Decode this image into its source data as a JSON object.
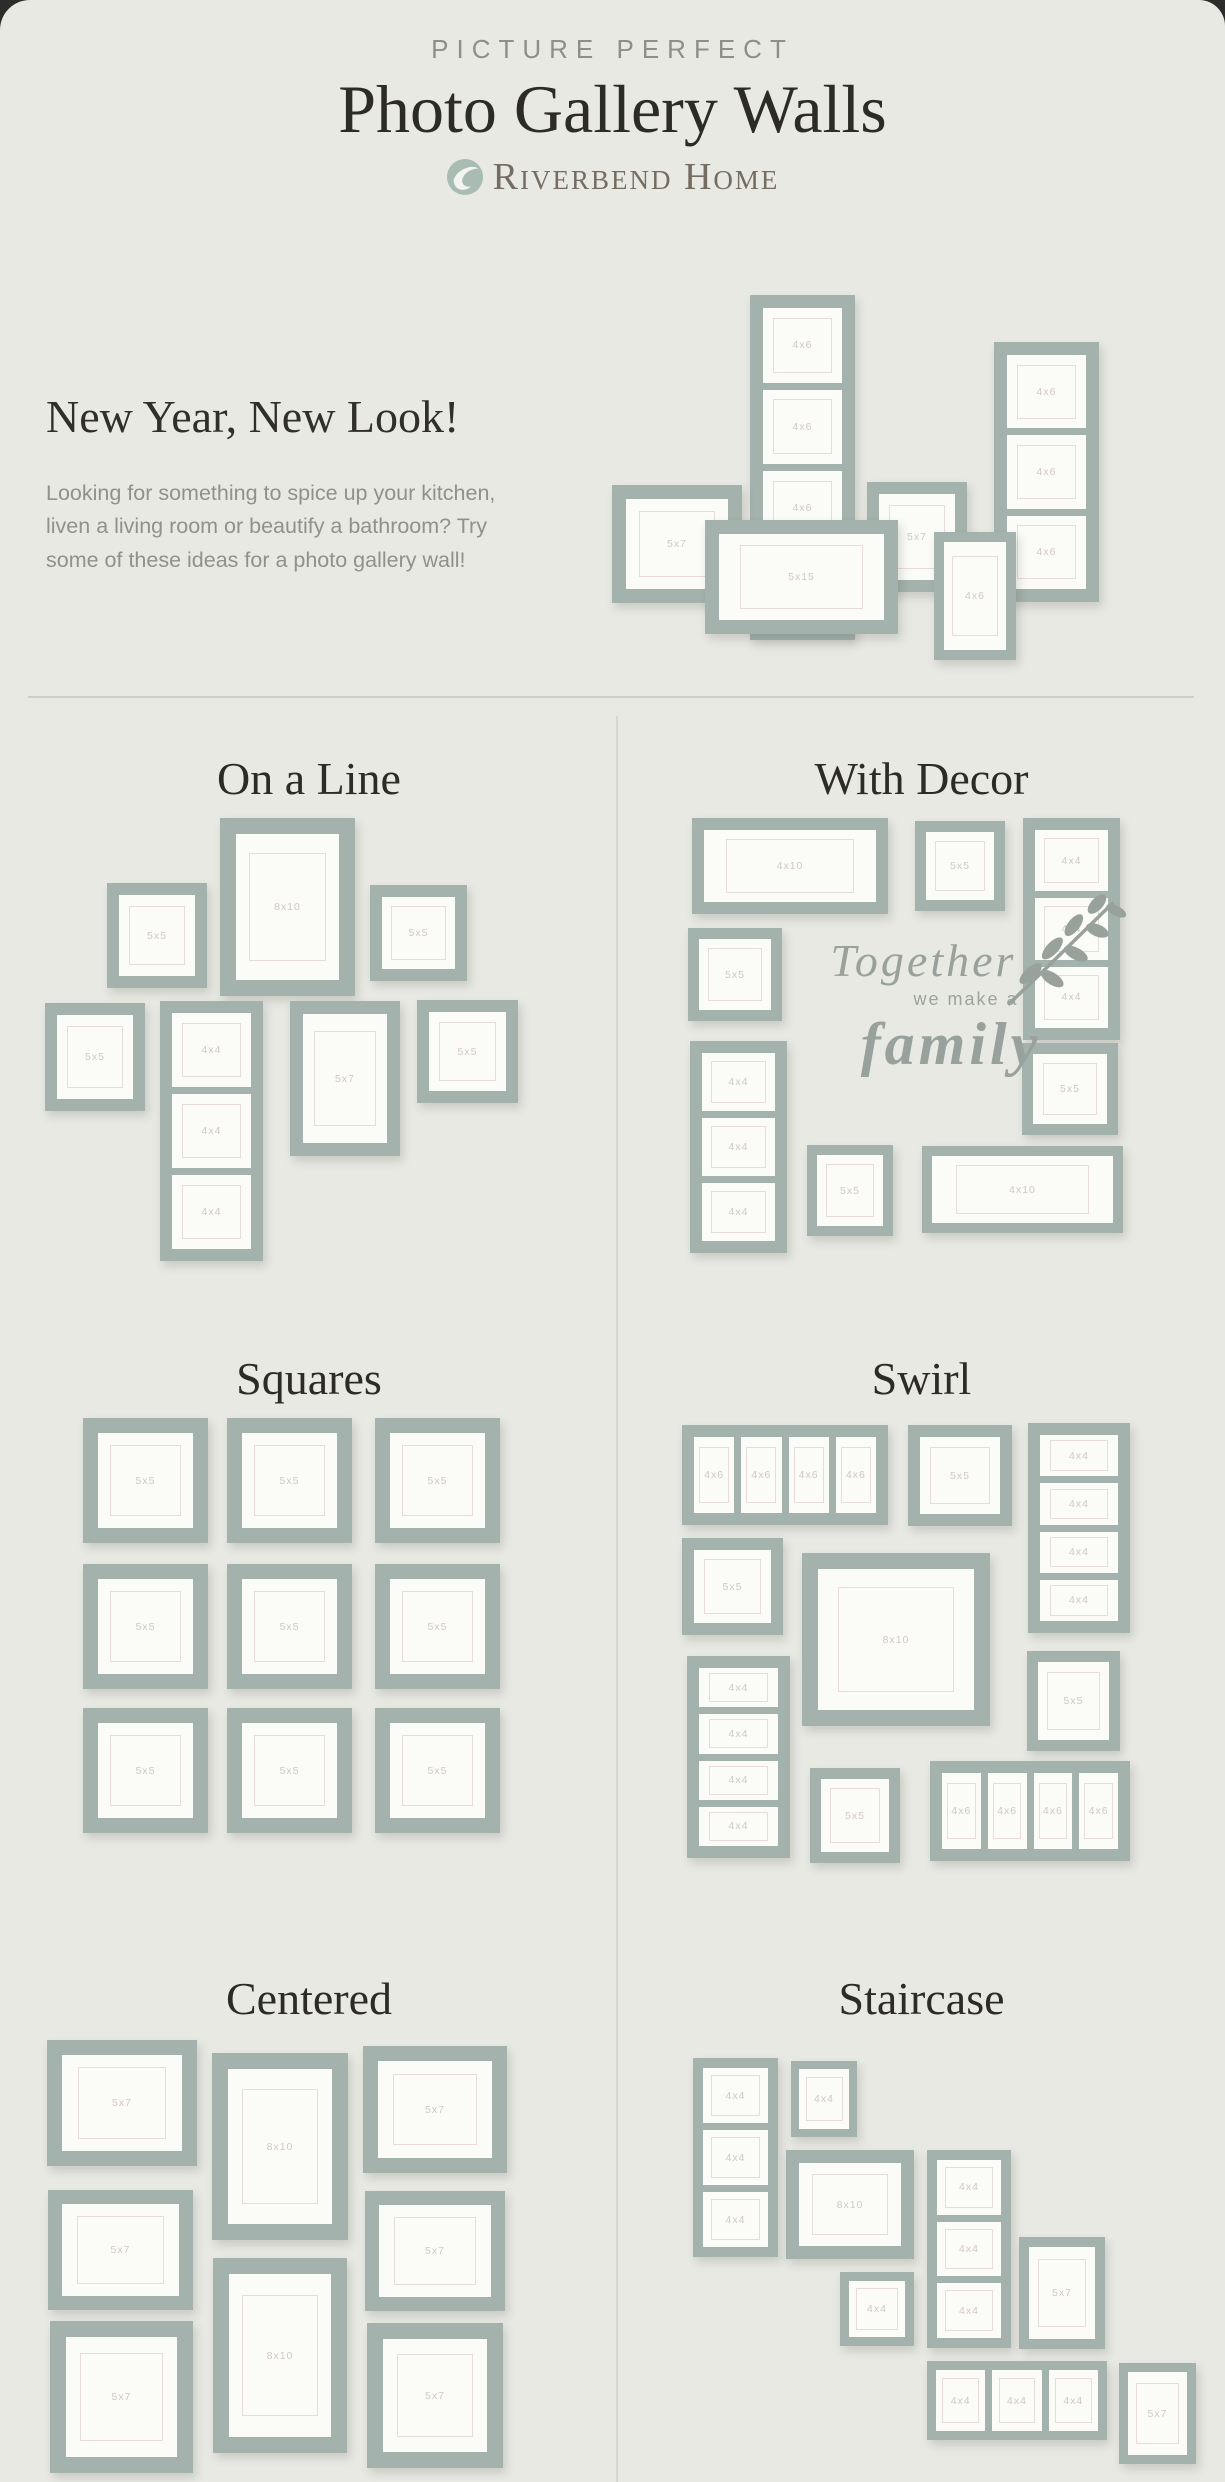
{
  "page": {
    "kicker": "PICTURE PERFECT",
    "title": "Photo Gallery Walls",
    "brand": "Riverbend Home",
    "intro_heading": "New Year, New Look!",
    "intro_body": "Looking for something to spice up your kitchen, liven a living room or beautify a bathroom? Try some of these ideas for a photo gallery wall!",
    "colors": {
      "sage": "#a3b2ac",
      "card-bg": "#e9e9e4",
      "ink": "#2d2b28",
      "decal": "#98a19c",
      "label": "#d2c7c7",
      "brand": "#766d62"
    }
  },
  "decal": {
    "line1": "Together",
    "line2": "we make a",
    "line3": "family"
  },
  "walls": {
    "hero": {
      "w": 585,
      "h": 375,
      "frames": [
        {
          "x": 138,
          "y": 5,
          "w": 105,
          "h": 345,
          "dir": "v",
          "z": 1,
          "openings": [
            "4x6",
            "4x6",
            "4x6",
            "4x6"
          ]
        },
        {
          "x": 0,
          "y": 195,
          "w": 130,
          "h": 118,
          "z": 2,
          "label": "5x7"
        },
        {
          "x": 93,
          "y": 230,
          "w": 193,
          "h": 114,
          "z": 3,
          "label": "5x15"
        },
        {
          "x": 255,
          "y": 192,
          "w": 100,
          "h": 110,
          "z": 2,
          "label": "5x7"
        },
        {
          "x": 322,
          "y": 242,
          "w": 82,
          "h": 128,
          "z": 4,
          "label": "4x6"
        },
        {
          "x": 382,
          "y": 52,
          "w": 105,
          "h": 260,
          "dir": "v",
          "z": 1,
          "openings": [
            "4x6",
            "4x6",
            "4x6"
          ]
        }
      ]
    },
    "on_a_line": {
      "title": "On a Line",
      "w": 473,
      "h": 445,
      "ml": 45,
      "frames": [
        {
          "x": 62,
          "y": 65,
          "w": 100,
          "h": 105,
          "label": "5x5"
        },
        {
          "x": 175,
          "y": 0,
          "w": 135,
          "h": 178,
          "label": "8x10"
        },
        {
          "x": 325,
          "y": 67,
          "w": 97,
          "h": 96,
          "label": "5x5"
        },
        {
          "x": 0,
          "y": 185,
          "w": 100,
          "h": 108,
          "label": "5x5"
        },
        {
          "x": 115,
          "y": 183,
          "w": 103,
          "h": 260,
          "dir": "v",
          "openings": [
            "4x4",
            "4x4",
            "4x4"
          ]
        },
        {
          "x": 245,
          "y": 183,
          "w": 110,
          "h": 155,
          "label": "5x7"
        },
        {
          "x": 372,
          "y": 182,
          "w": 101,
          "h": 103,
          "label": "5x5"
        }
      ]
    },
    "with_decor": {
      "title": "With Decor",
      "w": 435,
      "h": 435,
      "ml": 70,
      "frames": [
        {
          "x": 4,
          "y": 0,
          "w": 196,
          "h": 96,
          "label": "4x10"
        },
        {
          "x": 227,
          "y": 3,
          "w": 90,
          "h": 90,
          "label": "5x5"
        },
        {
          "x": 335,
          "y": 0,
          "w": 97,
          "h": 222,
          "dir": "v",
          "openings": [
            "4x4",
            "4x4",
            "4x4"
          ]
        },
        {
          "x": 0,
          "y": 110,
          "w": 94,
          "h": 93,
          "label": "5x5"
        },
        {
          "x": 2,
          "y": 223,
          "w": 97,
          "h": 212,
          "dir": "v",
          "openings": [
            "4x4",
            "4x4",
            "4x4"
          ]
        },
        {
          "x": 334,
          "y": 225,
          "w": 96,
          "h": 92,
          "label": "5x5"
        },
        {
          "x": 119,
          "y": 327,
          "w": 86,
          "h": 91,
          "label": "5x5"
        },
        {
          "x": 234,
          "y": 328,
          "w": 201,
          "h": 87,
          "label": "4x10"
        }
      ]
    },
    "squares": {
      "title": "Squares",
      "w": 417,
      "h": 420,
      "ml": 83,
      "frames": [
        {
          "x": 0,
          "y": 0,
          "w": 125,
          "h": 125,
          "label": "5x5"
        },
        {
          "x": 144,
          "y": 0,
          "w": 125,
          "h": 125,
          "label": "5x5"
        },
        {
          "x": 292,
          "y": 0,
          "w": 125,
          "h": 125,
          "label": "5x5"
        },
        {
          "x": 0,
          "y": 146,
          "w": 125,
          "h": 125,
          "label": "5x5"
        },
        {
          "x": 144,
          "y": 146,
          "w": 125,
          "h": 125,
          "label": "5x5"
        },
        {
          "x": 292,
          "y": 146,
          "w": 125,
          "h": 125,
          "label": "5x5"
        },
        {
          "x": 0,
          "y": 290,
          "w": 125,
          "h": 125,
          "label": "5x5"
        },
        {
          "x": 144,
          "y": 290,
          "w": 125,
          "h": 125,
          "label": "5x5"
        },
        {
          "x": 292,
          "y": 290,
          "w": 125,
          "h": 125,
          "label": "5x5"
        }
      ]
    },
    "swirl": {
      "title": "Swirl",
      "w": 448,
      "h": 445,
      "ml": 64,
      "frames": [
        {
          "x": 0,
          "y": 7,
          "w": 206,
          "h": 100,
          "dir": "h",
          "openings": [
            "4x6",
            "4x6",
            "4x6",
            "4x6"
          ]
        },
        {
          "x": 226,
          "y": 7,
          "w": 104,
          "h": 101,
          "label": "5x5"
        },
        {
          "x": 346,
          "y": 5,
          "w": 102,
          "h": 210,
          "dir": "v",
          "openings": [
            "4x4",
            "4x4",
            "4x4",
            "4x4"
          ]
        },
        {
          "x": 0,
          "y": 120,
          "w": 101,
          "h": 97,
          "label": "5x5"
        },
        {
          "x": 120,
          "y": 135,
          "w": 188,
          "h": 173,
          "label": "8x10"
        },
        {
          "x": 5,
          "y": 238,
          "w": 103,
          "h": 202,
          "dir": "v",
          "openings": [
            "4x4",
            "4x4",
            "4x4",
            "4x4"
          ]
        },
        {
          "x": 345,
          "y": 233,
          "w": 93,
          "h": 100,
          "label": "5x5"
        },
        {
          "x": 128,
          "y": 350,
          "w": 90,
          "h": 95,
          "label": "5x5"
        },
        {
          "x": 248,
          "y": 343,
          "w": 200,
          "h": 100,
          "dir": "h",
          "openings": [
            "4x6",
            "4x6",
            "4x6",
            "4x6"
          ]
        }
      ]
    },
    "centered": {
      "title": "Centered",
      "w": 460,
      "h": 437,
      "ml": 47,
      "frames": [
        {
          "x": 0,
          "y": 2,
          "w": 150,
          "h": 126,
          "label": "5x7"
        },
        {
          "x": 165,
          "y": 15,
          "w": 136,
          "h": 187,
          "label": "8x10"
        },
        {
          "x": 316,
          "y": 8,
          "w": 144,
          "h": 127,
          "label": "5x7"
        },
        {
          "x": 1,
          "y": 152,
          "w": 145,
          "h": 120,
          "label": "5x7"
        },
        {
          "x": 318,
          "y": 153,
          "w": 140,
          "h": 120,
          "label": "5x7"
        },
        {
          "x": 166,
          "y": 220,
          "w": 134,
          "h": 195,
          "label": "8x10"
        },
        {
          "x": 3,
          "y": 283,
          "w": 143,
          "h": 152,
          "label": "5x7"
        },
        {
          "x": 320,
          "y": 285,
          "w": 136,
          "h": 145,
          "label": "5x7"
        }
      ]
    },
    "staircase": {
      "title": "Staircase",
      "w": 503,
      "h": 430,
      "ml": 75,
      "frames": [
        {
          "x": 0,
          "y": 20,
          "w": 85,
          "h": 199,
          "dir": "v",
          "openings": [
            "4x4",
            "4x4",
            "4x4"
          ]
        },
        {
          "x": 98,
          "y": 23,
          "w": 66,
          "h": 76,
          "label": "4x4"
        },
        {
          "x": 93,
          "y": 112,
          "w": 128,
          "h": 109,
          "label": "8x10"
        },
        {
          "x": 234,
          "y": 112,
          "w": 84,
          "h": 198,
          "dir": "v",
          "openings": [
            "4x4",
            "4x4",
            "4x4"
          ]
        },
        {
          "x": 147,
          "y": 234,
          "w": 74,
          "h": 74,
          "label": "4x4"
        },
        {
          "x": 326,
          "y": 199,
          "w": 86,
          "h": 112,
          "label": "5x7"
        },
        {
          "x": 234,
          "y": 323,
          "w": 180,
          "h": 79,
          "dir": "h",
          "openings": [
            "4x4",
            "4x4",
            "4x4"
          ]
        },
        {
          "x": 426,
          "y": 325,
          "w": 77,
          "h": 101,
          "label": "5x7"
        }
      ]
    }
  }
}
